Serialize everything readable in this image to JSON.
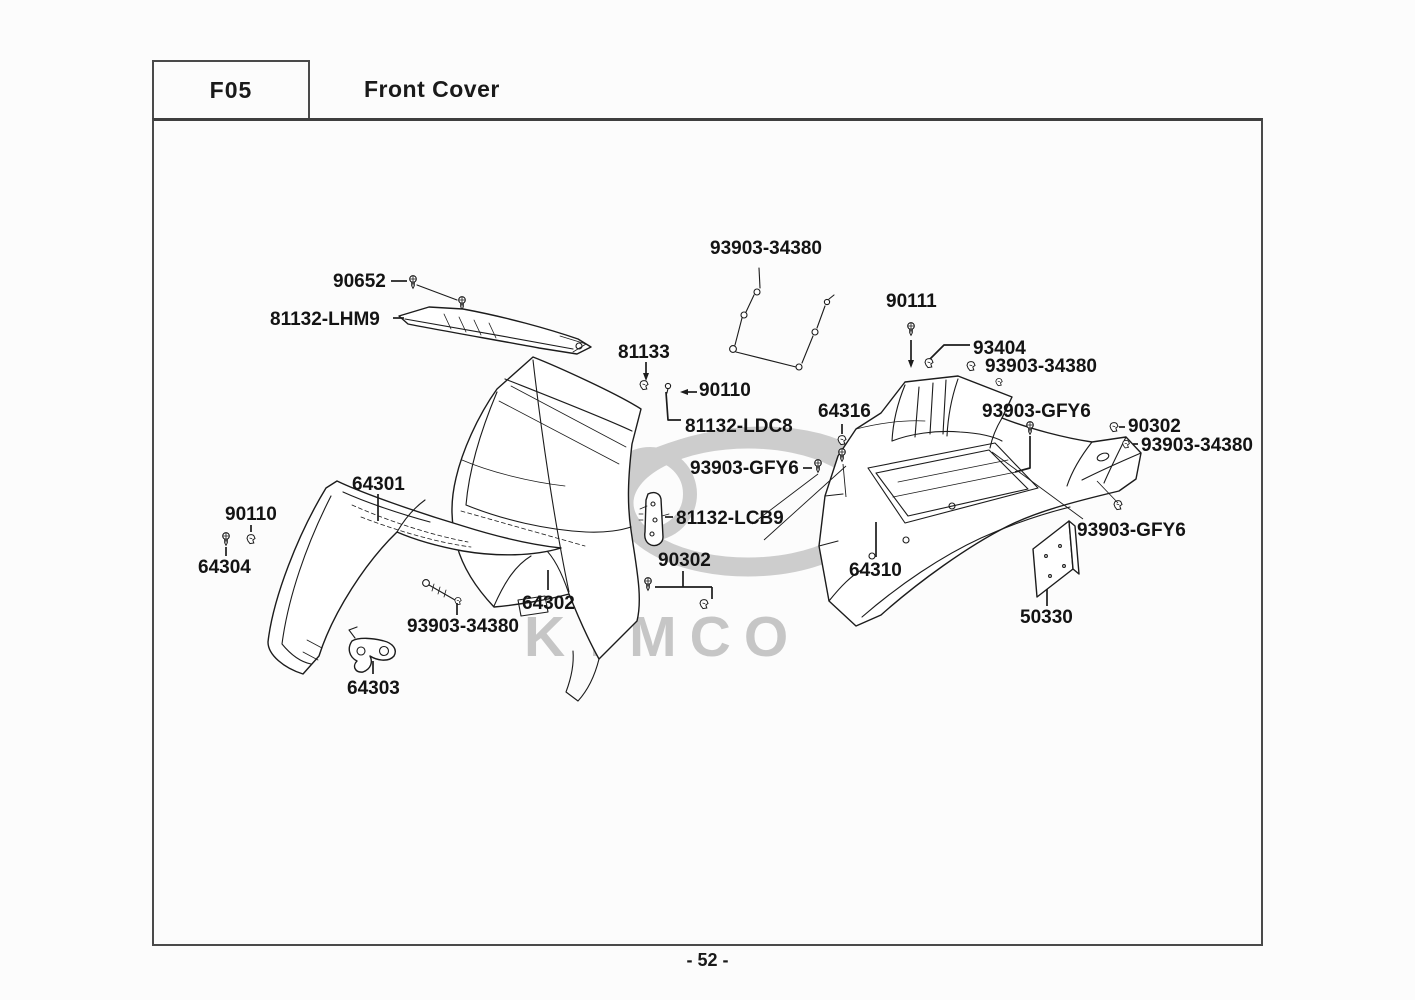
{
  "page": {
    "code": "F05",
    "title": "Front Cover",
    "page_number": "- 52 -",
    "watermark": "KYMCO",
    "colors": {
      "line": "#1c1c1c",
      "watermark": "#c9c9c9",
      "border": "#4a4a4a",
      "background": "#fcfcfc"
    }
  },
  "diagram": {
    "part_labels": [
      {
        "id": "label-93903-34380-top",
        "text": "93903-34380",
        "x": 710,
        "y": 239
      },
      {
        "id": "label-90652",
        "text": "90652",
        "x": 333,
        "y": 272
      },
      {
        "id": "label-90111",
        "text": "90111",
        "x": 886,
        "y": 292
      },
      {
        "id": "label-81132-LHM9",
        "text": "81132-LHM9",
        "x": 270,
        "y": 310
      },
      {
        "id": "label-93404",
        "text": "93404",
        "x": 973,
        "y": 339
      },
      {
        "id": "label-81133",
        "text": "81133",
        "x": 618,
        "y": 343
      },
      {
        "id": "label-93903-34380-right",
        "text": "93903-34380",
        "x": 985,
        "y": 357
      },
      {
        "id": "label-90110-top",
        "text": "90110",
        "x": 699,
        "y": 381
      },
      {
        "id": "label-64316",
        "text": "64316",
        "x": 818,
        "y": 402
      },
      {
        "id": "label-93903-GFY6-right",
        "text": "93903-GFY6",
        "x": 982,
        "y": 402
      },
      {
        "id": "label-81132-LDC8",
        "text": "81132-LDC8",
        "x": 685,
        "y": 417
      },
      {
        "id": "label-90302-right",
        "text": "90302",
        "x": 1128,
        "y": 417
      },
      {
        "id": "label-93903-34380-right-lower",
        "text": "93903-34380",
        "x": 1141,
        "y": 436
      },
      {
        "id": "label-93903-GFY6-middle",
        "text": "93903-GFY6",
        "x": 690,
        "y": 459
      },
      {
        "id": "label-64301",
        "text": "64301",
        "x": 352,
        "y": 475
      },
      {
        "id": "label-90110-left",
        "text": "90110",
        "x": 225,
        "y": 505
      },
      {
        "id": "label-81132-LCB9",
        "text": "81132-LCB9",
        "x": 676,
        "y": 509
      },
      {
        "id": "label-93903-GFY6-bottom-right",
        "text": "93903-GFY6",
        "x": 1077,
        "y": 521
      },
      {
        "id": "label-90302-middle",
        "text": "90302",
        "x": 658,
        "y": 551
      },
      {
        "id": "label-64304",
        "text": "64304",
        "x": 198,
        "y": 558
      },
      {
        "id": "label-64310",
        "text": "64310",
        "x": 849,
        "y": 561
      },
      {
        "id": "label-64302",
        "text": "64302",
        "x": 522,
        "y": 594
      },
      {
        "id": "label-50330",
        "text": "50330",
        "x": 1020,
        "y": 608
      },
      {
        "id": "label-93903-34380-bottom-left",
        "text": "93903-34380",
        "x": 407,
        "y": 617
      },
      {
        "id": "label-64303",
        "text": "64303",
        "x": 347,
        "y": 679
      }
    ]
  }
}
